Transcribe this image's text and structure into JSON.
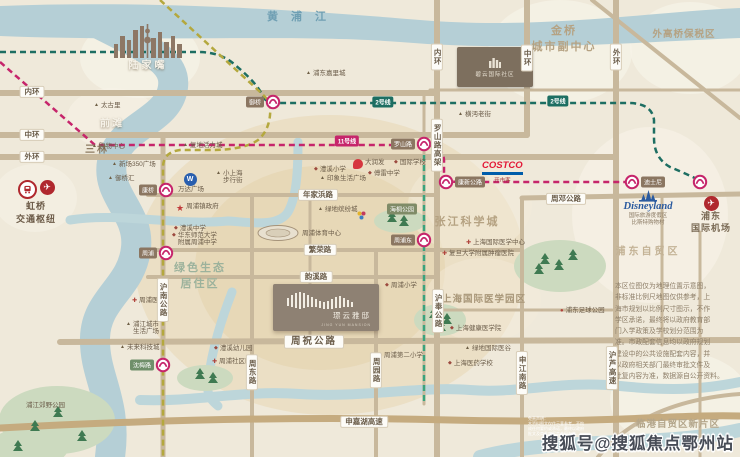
{
  "map_title": "周浦板块区位示意图",
  "colors": {
    "paper": "#efe9da",
    "river": "#b5cfd6",
    "road": "#c8b89c",
    "metro_line2": "#1d6e62",
    "metro_line11": "#c6256b",
    "metro_line16": "#3aa37d",
    "metro_line18": "#b4a83e",
    "station_ring": "#c6256b",
    "label_pill": "#8b7661",
    "costco_red": "#e31837",
    "costco_blue": "#005daa",
    "disney_blue": "#2a5a9f",
    "wanda_blue": "#2a5fae",
    "highlight": "#e7d7b4"
  },
  "river_label": {
    "text": "黄浦江"
  },
  "hongqiao": {
    "line1": "虹桥",
    "line2": "交通枢纽",
    "icons": [
      "train-icon",
      "plane-icon"
    ]
  },
  "airport": {
    "line1": "浦东",
    "line2": "国际机场",
    "icon": "plane-icon"
  },
  "disney": {
    "logo": "Disneyland",
    "sub1": "国际旅游度假区",
    "sub2": "比斯特购物村",
    "icon": "castle-icon"
  },
  "costco": {
    "logo": "COSTCO",
    "sub": "开市客"
  },
  "biyun": {
    "label": "碧云国际社区",
    "icon": "building-icon"
  },
  "project": {
    "name": "璟云雅邸",
    "sub": "JING YUN MANSION",
    "icon": "bars-logo"
  },
  "watermark": {
    "text": "搜狐号@搜狐焦点鄂州站"
  },
  "areas": [
    {
      "text": "陆家嘴",
      "x": 148,
      "y": 64,
      "size": 10,
      "color": "#f6f2e8",
      "ls": 3,
      "shadow": true
    },
    {
      "text": "前滩",
      "x": 112,
      "y": 122,
      "size": 10,
      "color": "#f6f2e8",
      "ls": 2,
      "shadow": true
    },
    {
      "text": "三林",
      "x": 97,
      "y": 148,
      "size": 10,
      "color": "#8d7b62",
      "ls": 2
    },
    {
      "lines": [
        "金桥",
        "城市副中心"
      ],
      "x": 564,
      "y": 38,
      "size": 11,
      "color": "#b5a282",
      "ls": 2
    },
    {
      "text": "外高桥保税区",
      "x": 684,
      "y": 33,
      "size": 9.5,
      "color": "#b5a282",
      "ls": 1
    },
    {
      "text": "张江科学城",
      "x": 467,
      "y": 221,
      "size": 11,
      "color": "#b5a282",
      "ls": 2
    },
    {
      "lines": [
        "绿色生态",
        "居住区"
      ],
      "x": 200,
      "y": 275,
      "size": 11,
      "color": "#9cb29c",
      "ls": 2
    },
    {
      "text": "上海国际医学园区",
      "x": 484,
      "y": 298,
      "size": 9.5,
      "color": "#a89678",
      "ls": 1
    },
    {
      "text": "浦东自贸区",
      "x": 648,
      "y": 250,
      "size": 10,
      "color": "#c3b295",
      "ls": 3
    },
    {
      "text": "临港自贸区新片区",
      "x": 678,
      "y": 423,
      "size": 9.5,
      "color": "#b3a58a",
      "ls": 1
    }
  ],
  "road_labels": [
    {
      "text": "内环",
      "x": 32,
      "y": 92
    },
    {
      "text": "中环",
      "x": 32,
      "y": 135
    },
    {
      "text": "外环",
      "x": 32,
      "y": 157
    },
    {
      "text": "内环",
      "x": 437,
      "y": 57,
      "v": true
    },
    {
      "text": "中环",
      "x": 527,
      "y": 58,
      "v": true
    },
    {
      "text": "外环",
      "x": 616,
      "y": 57,
      "v": true
    },
    {
      "text": "年家浜路",
      "x": 318,
      "y": 195
    },
    {
      "text": "繁荣路",
      "x": 320,
      "y": 250
    },
    {
      "text": "韵溪路",
      "x": 316,
      "y": 277
    },
    {
      "text": "周祝公路",
      "x": 314,
      "y": 342,
      "big": true
    },
    {
      "text": "周邓公路",
      "x": 566,
      "y": 199
    },
    {
      "text": "申嘉湖高速",
      "x": 364,
      "y": 422
    },
    {
      "text": "罗山路高架",
      "x": 437,
      "y": 145,
      "v": true
    },
    {
      "text": "沪南公路",
      "x": 163,
      "y": 300,
      "v": true
    },
    {
      "text": "沪奉公路",
      "x": 438,
      "y": 311,
      "v": true
    },
    {
      "text": "周东路",
      "x": 252,
      "y": 372,
      "v": true
    },
    {
      "text": "周园路",
      "x": 376,
      "y": 370,
      "v": true
    },
    {
      "text": "申江南路",
      "x": 522,
      "y": 373,
      "v": true
    },
    {
      "text": "沪芦高速",
      "x": 612,
      "y": 368,
      "v": true
    }
  ],
  "tags": [
    {
      "text": "海桐公园",
      "x": 402,
      "y": 209,
      "bg": "#7f8b67"
    }
  ],
  "line_badges": [
    {
      "text": "2号线",
      "x": 383,
      "y": 102,
      "bg": "#1d6e62"
    },
    {
      "text": "2号线",
      "x": 558,
      "y": 101,
      "bg": "#1d6e62"
    },
    {
      "text": "11号线",
      "x": 347,
      "y": 141,
      "bg": "#c6256b"
    }
  ],
  "stations": [
    {
      "x": 273,
      "y": 102,
      "label": "御桥",
      "side": "left"
    },
    {
      "x": 166,
      "y": 190,
      "label": "康桥",
      "side": "left"
    },
    {
      "x": 166,
      "y": 253,
      "label": "周浦",
      "side": "left"
    },
    {
      "x": 163,
      "y": 365,
      "label": "沈梅路",
      "side": "left",
      "bg": "#6f8f6a"
    },
    {
      "x": 424,
      "y": 144,
      "label": "罗山路",
      "side": "left"
    },
    {
      "x": 446,
      "y": 182,
      "label": "康新公路",
      "side": "right"
    },
    {
      "x": 424,
      "y": 240,
      "label": "周浦东",
      "side": "left"
    },
    {
      "x": 632,
      "y": 182,
      "label": "迪士尼",
      "side": "right"
    },
    {
      "x": 700,
      "y": 182,
      "label": "",
      "side": "right"
    }
  ],
  "pois": [
    {
      "icon": "mall-icon",
      "label": "浦东嘉里城",
      "x": 306,
      "y": 73
    },
    {
      "icon": "mall-icon",
      "label": "太古里",
      "x": 94,
      "y": 105
    },
    {
      "icon": "mall-icon",
      "label": "购物中心",
      "x": 92,
      "y": 146
    },
    {
      "icon": "mall-icon",
      "label": "复地活力城",
      "x": 183,
      "y": 145
    },
    {
      "icon": "mall-icon",
      "label": "新场350广场",
      "x": 112,
      "y": 164
    },
    {
      "icon": "mall-icon",
      "label": "御桥汇",
      "x": 108,
      "y": 178
    },
    {
      "icon": "mall-icon",
      "lines": [
        "小上海",
        "步行街"
      ],
      "x": 216,
      "y": 173
    },
    {
      "icon": "wanda-logo",
      "lines": [
        "万达广场"
      ],
      "x": 191,
      "y": 176,
      "below": true
    },
    {
      "icon": "star-icon",
      "label": "周浦镇政府",
      "x": 176,
      "y": 206
    },
    {
      "icon": "school-icon",
      "label": "澧溪中学",
      "x": 174,
      "y": 228
    },
    {
      "icon": "school-icon",
      "lines": [
        "华东师范大学",
        "附属周浦中学"
      ],
      "x": 172,
      "y": 235
    },
    {
      "icon": "rtmart-logo",
      "label": "大润发",
      "x": 353,
      "y": 162
    },
    {
      "icon": "school-icon",
      "label": "澧溪小学",
      "x": 314,
      "y": 169
    },
    {
      "icon": "school-icon",
      "label": "傅雷中学",
      "x": 368,
      "y": 173
    },
    {
      "icon": "mall-icon",
      "label": "印象生活广场",
      "x": 320,
      "y": 178
    },
    {
      "icon": "school-icon",
      "label": "国际学校",
      "x": 394,
      "y": 162
    },
    {
      "icon": "mall-icon",
      "label": "绿地缤纷城",
      "x": 318,
      "y": 209
    },
    {
      "icon": "none",
      "label": "周浦体育中心",
      "x": 302,
      "y": 233
    },
    {
      "icon": "mall-icon",
      "label": "横沔老街",
      "x": 458,
      "y": 114
    },
    {
      "icon": "hospital-icon",
      "label": "上海国际医学中心",
      "x": 466,
      "y": 242
    },
    {
      "icon": "hospital-icon",
      "label": "复旦大学附属肿瘤医院",
      "x": 442,
      "y": 253
    },
    {
      "icon": "school-icon",
      "label": "上海健康医学院",
      "x": 450,
      "y": 328
    },
    {
      "icon": "mall-icon",
      "label": "绿地国际医谷",
      "x": 465,
      "y": 348
    },
    {
      "icon": "school-icon",
      "label": "上海医药学校",
      "x": 448,
      "y": 363
    },
    {
      "icon": "dot-icon",
      "label": "浦东足球公园",
      "x": 560,
      "y": 310
    },
    {
      "icon": "school-icon",
      "label": "周浦第二小学",
      "x": 378,
      "y": 355
    },
    {
      "icon": "school-icon",
      "label": "周浦小学",
      "x": 385,
      "y": 285
    },
    {
      "icon": "school-icon",
      "label": "澧溪幼儿园",
      "x": 214,
      "y": 348
    },
    {
      "icon": "hospital-icon",
      "label": "周浦社区医院",
      "x": 212,
      "y": 361
    },
    {
      "icon": "hospital-icon",
      "label": "周浦医院",
      "x": 132,
      "y": 300
    },
    {
      "icon": "mall-icon",
      "label": "未来科技城",
      "x": 120,
      "y": 347
    },
    {
      "icon": "mall-icon",
      "lines": [
        "浦江城市",
        "生活广场"
      ],
      "x": 126,
      "y": 324
    },
    {
      "icon": "none",
      "label": "浦江郊野公园",
      "x": 26,
      "y": 405,
      "cls": "park-text"
    }
  ],
  "disclaimer": {
    "lines": [
      "本区位图仅为地理位置示意图，",
      "非标准比例尺地图仅供参考，上",
      "海市规划以比例尺寸图示，不作",
      "学区承诺，最终将以政府教育部",
      "门入学政策及学校划分范围为",
      "准。市政配套信息均以政府规划",
      "建设中的公共设施配套内容，并",
      "以政府相关部门最终审批文件及",
      "批复内容为准，数据源自公开资料。"
    ]
  },
  "fine_print": {
    "lines": [
      "免责声明：",
      "本资料图文仅作示意参考，不构",
      "成任何要约或承诺，最终以政府",
      "批文及商品房买卖合同为准。"
    ]
  }
}
